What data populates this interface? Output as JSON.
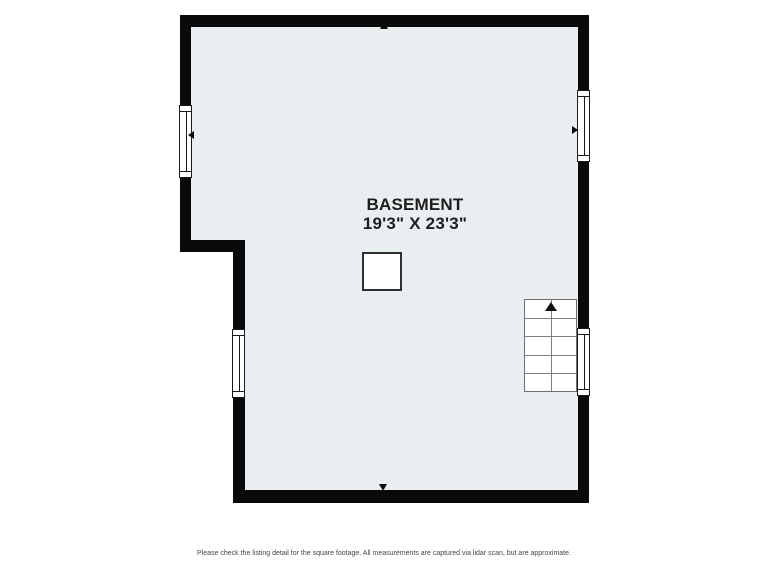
{
  "room": {
    "name": "BASEMENT",
    "dimensions": "19'3\" X 23'3\""
  },
  "footer": {
    "disclaimer": "Please check the listing detail for the square footage. All measurements are captured via lidar scan, but are approximate."
  },
  "icons": {
    "stairs_arrow": "up-arrow",
    "marker_top": "up-arrow",
    "marker_bottom": "down-arrow",
    "marker_left": "left-arrow",
    "marker_right": "right-arrow"
  },
  "colors": {
    "wall": "#0a0a0a",
    "floor": "#e9eef0",
    "background": "#ffffff",
    "stairs_outline": "#6e6e6e",
    "label_text": "#1e1e1e",
    "footer_text": "#454545"
  }
}
